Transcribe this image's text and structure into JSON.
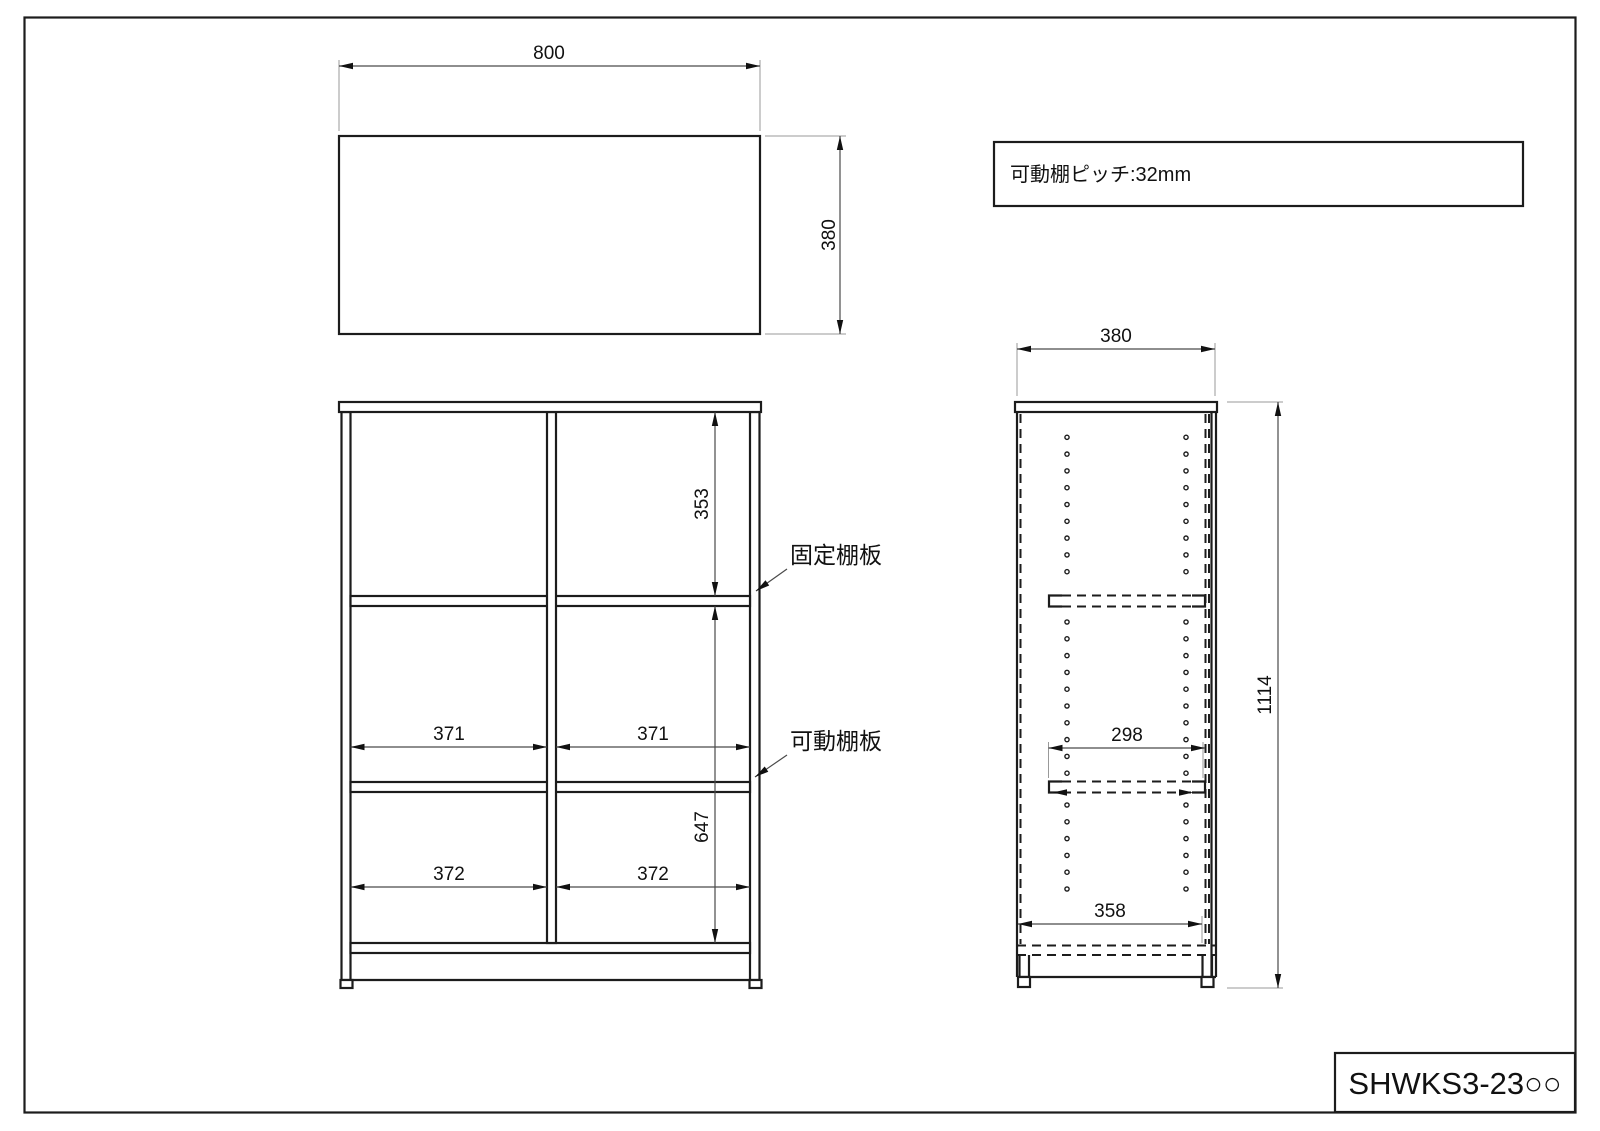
{
  "note": {
    "text": "可動棚ピッチ:32mm"
  },
  "title_block": {
    "model": "SHWKS3-23○○"
  },
  "annotations": {
    "fixed_shelf": "固定棚板",
    "movable_shelf": "可動棚板"
  },
  "dims": {
    "top_view_width": "800",
    "top_view_depth": "380",
    "front_top_cell_height": "353",
    "front_bottom_section_height": "647",
    "front_upper_cell_width_left": "371",
    "front_upper_cell_width_right": "371",
    "front_lower_cell_width_left": "372",
    "front_lower_cell_width_right": "372",
    "side_depth": "380",
    "side_shelf_depth": "298",
    "side_base_depth": "358",
    "side_height": "1114"
  }
}
